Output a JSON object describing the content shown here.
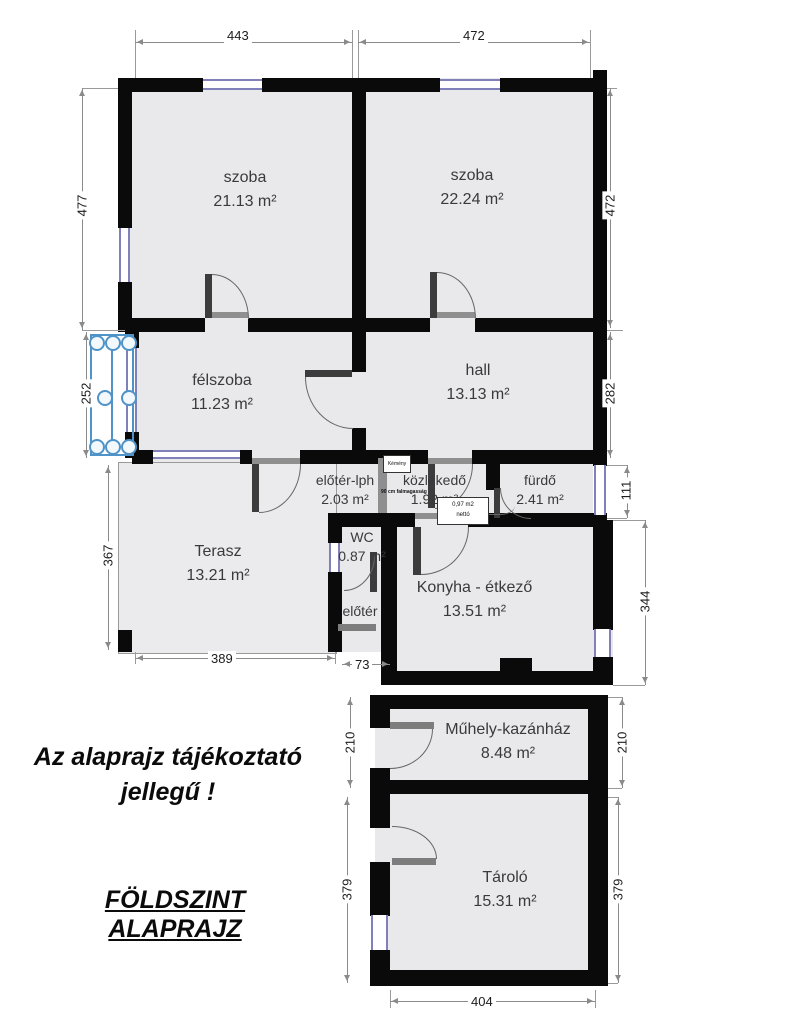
{
  "rooms": [
    {
      "name": "szoba",
      "area": "21.13 m²"
    },
    {
      "name": "szoba",
      "area": "22.24 m²"
    },
    {
      "name": "félszoba",
      "area": "11.23 m²"
    },
    {
      "name": "hall",
      "area": "13.13 m²"
    },
    {
      "name": "előtér-lph",
      "area": "2.03 m²"
    },
    {
      "name": "közlekedő",
      "area": "1.92 m²"
    },
    {
      "name": "fürdő",
      "area": "2.41 m²"
    },
    {
      "name": "Terasz",
      "area": "13.21 m²"
    },
    {
      "name": "WC",
      "area": "0.87 m²"
    },
    {
      "name": "előtér",
      "area": ""
    },
    {
      "name": "Konyha - étkező",
      "area": "13.51 m²"
    },
    {
      "name": "Műhely-kazánház",
      "area": "8.48 m²"
    },
    {
      "name": "Tároló",
      "area": "15.31 m²"
    }
  ],
  "dimensions": {
    "top_left": "443",
    "top_right": "472",
    "left_upper": "477",
    "left_mid": "252",
    "left_terasz": "367",
    "right_upper": "472",
    "right_hall": "282",
    "right_furdo": "111",
    "right_konyha": "344",
    "right_muhely": "210",
    "right_tarolo": "379",
    "left_muhely": "210",
    "left_tarolo": "379",
    "bottom_terasz": "389",
    "bottom_eloter": "73",
    "bottom_tarolo": "404"
  },
  "annotations": {
    "disclaimer": "Az alaprajz tájékoztató jellegű !",
    "title": "FÖLDSZINT ALAPRAJZ",
    "net_area_box": "0,97 m2 nettó",
    "chimney_label": "Kémény",
    "wall_height_note": "90 cm falmagasság"
  },
  "colors": {
    "wall": "#0a0a0a",
    "room_fill": "#e9e9eb",
    "window_blue": "#8080bb",
    "stair_blue": "#4f93c8",
    "dimension_gray": "#8a8a8a"
  }
}
